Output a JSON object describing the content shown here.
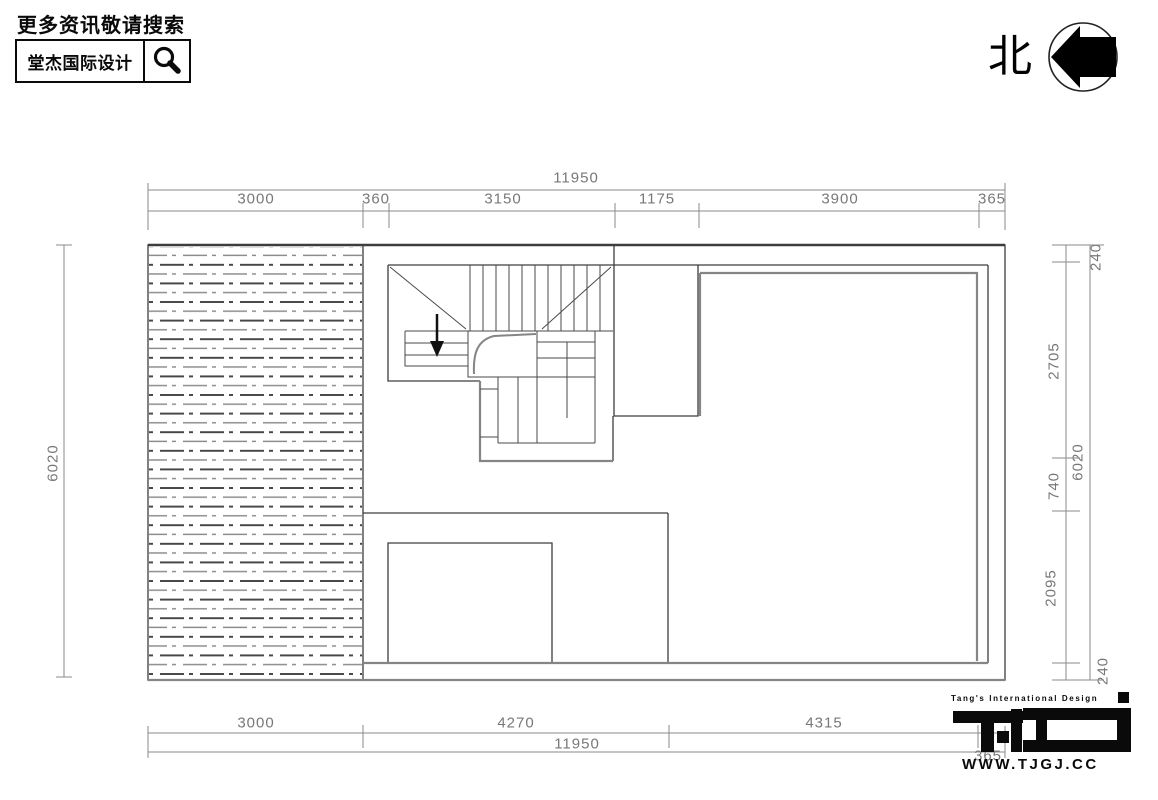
{
  "header": {
    "search_hint": "更多资讯敬请搜索",
    "brand_name": "堂杰国际设计",
    "search_icon": "magnifier-icon"
  },
  "north_indicator": {
    "label": "北"
  },
  "dimensions": {
    "top": {
      "total": "11950",
      "chain": [
        "3000",
        "360",
        "3150",
        "1175",
        "3900",
        "365"
      ]
    },
    "bottom": {
      "total": "11950",
      "chain": [
        "3000",
        "4270",
        "4315",
        "365"
      ]
    },
    "left": {
      "total": "6020"
    },
    "right": {
      "total": "6020",
      "chain": [
        "240",
        "2705",
        "740",
        "2095",
        "240"
      ]
    }
  },
  "footer": {
    "brand": "Tang's International Design",
    "logo_monogram": "TJD",
    "website": "WWW.TJGJ.CC"
  },
  "colors": {
    "plan_line": "#3d3d3d",
    "heavy_gray_line": "#858585",
    "dimension": "#787878",
    "ink": "#0a0a0a"
  }
}
